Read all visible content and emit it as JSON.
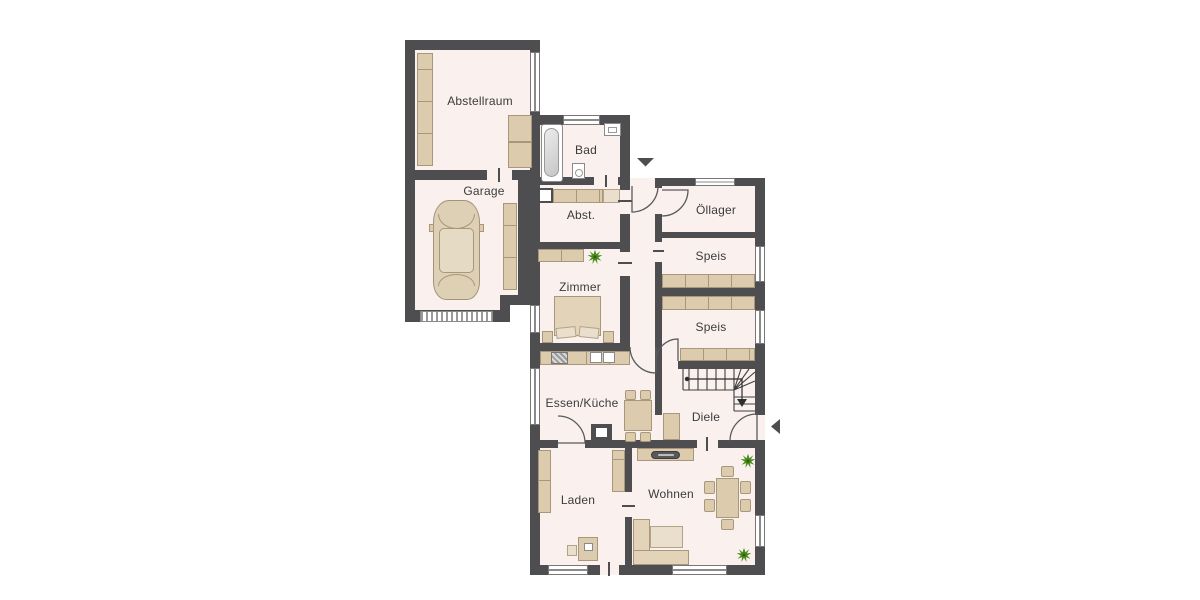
{
  "plan": {
    "rooms": {
      "abstellraum": {
        "label": "Abstellraum"
      },
      "garage": {
        "label": "Garage"
      },
      "bad": {
        "label": "Bad"
      },
      "abst": {
        "label": "Abst."
      },
      "oellager": {
        "label": "Öllager"
      },
      "speis1": {
        "label": "Speis"
      },
      "zimmer": {
        "label": "Zimmer"
      },
      "speis2": {
        "label": "Speis"
      },
      "essen_kueche": {
        "label": "Essen/Küche"
      },
      "diele": {
        "label": "Diele"
      },
      "laden": {
        "label": "Laden"
      },
      "wohnen": {
        "label": "Wohnen"
      }
    },
    "markers": {
      "rear_entrance_arrow": "down-arrow",
      "main_entrance_arrow": "left-arrow",
      "stairs_direction": "down-arrow"
    },
    "colors": {
      "wall": "#4e4e50",
      "floor": "#faf1ef",
      "furniture": "#ddcbae",
      "furniture_light": "#e9dfcc",
      "plant": "#4a8a1c",
      "label_text": "#3b3b3b",
      "background": "#ffffff"
    }
  }
}
